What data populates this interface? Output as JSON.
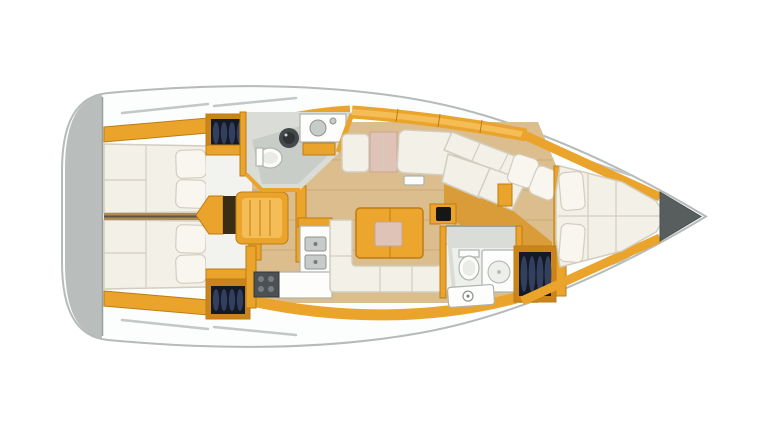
{
  "scene": {
    "description": "Top-down interior floor plan of a sailing yacht, bow pointing right",
    "type": "boat-floorplan",
    "view": "top-down",
    "orientation": "bow-right"
  },
  "areas": [
    "stern-swim-platform",
    "aft-cabin-port",
    "aft-cabin-starboard",
    "companionway-steps",
    "aft-head",
    "galley",
    "saloon-u-settee",
    "saloon-table",
    "starboard-settee",
    "forward-dinette",
    "forward-head",
    "hanging-lockers",
    "forward-cabin-v-berth",
    "anchor-locker"
  ],
  "colors": {
    "background": "#ffffff",
    "hull_fill": "#fcfdfd",
    "hull_stroke": "#b5baba",
    "deck_line": "#c2c7c7",
    "transom": "#b9bdbc",
    "wood": "#eaa42c",
    "wood_light": "#f4bd55",
    "wood_dark": "#bd7d12",
    "floor": "#dcbd8d",
    "floor_line": "#cdab76",
    "amber_floor": "#d99c38",
    "cushion": "#f3f0e8",
    "cushion_seam": "#d2cdbe",
    "pillow": "#f9f6f0",
    "pink": "#e0c3b7",
    "pink_stroke": "#c7a493",
    "head_wall": "#dadcd7",
    "head_floor": "#c9cdc8",
    "fixture": "#fdfdfc",
    "fixture_stroke": "#adb3ae",
    "steel": "#c7cbc9",
    "steel_dark": "#8f9592",
    "stove": "#4d5154",
    "burner": "#777d80",
    "basin": "#45494b",
    "locker_frame": "#c9851c",
    "locker_dark": "#131925",
    "locker_cloth": "#333f5f",
    "anchor": "#585e5e",
    "divider": "#b08a52",
    "table_top": "#eca62e",
    "step_gap": "#3a2d15",
    "entry_floor": "#f2f2ee"
  }
}
